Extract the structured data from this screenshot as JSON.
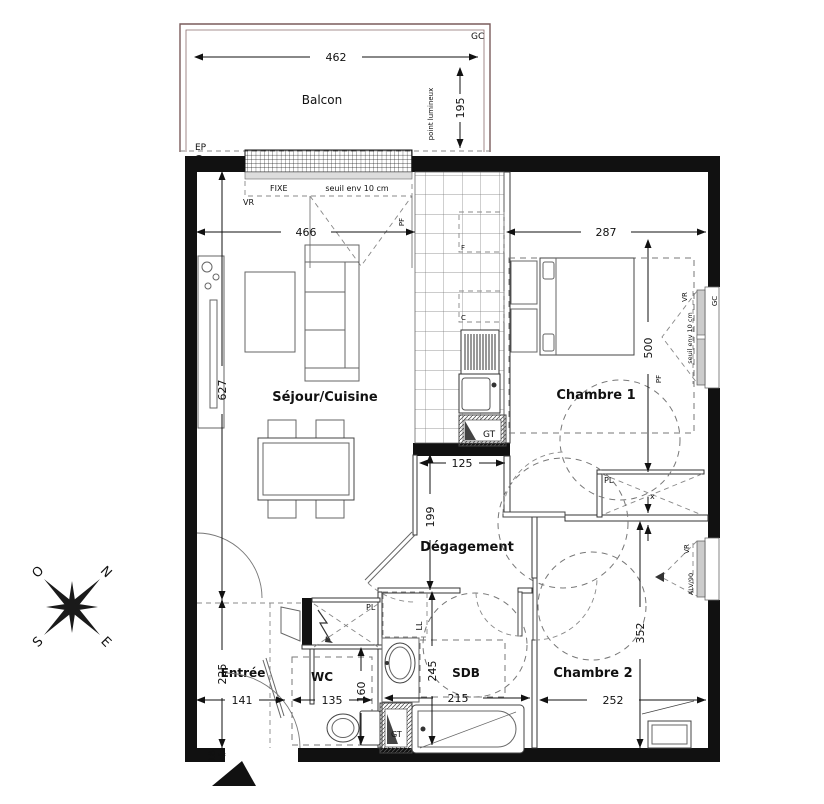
{
  "plan": {
    "rooms": {
      "balcon": "Balcon",
      "sejour_cuisine": "Séjour/Cuisine",
      "chambre1": "Chambre 1",
      "degagement": "Dégagement",
      "entree": "Entrée",
      "wc": "WC",
      "sdb": "SDB",
      "chambre2": "Chambre 2"
    },
    "dims": {
      "balcon_width": "462",
      "balcon_depth": "195",
      "sejour_width": "466",
      "chambre1_width": "287",
      "sejour_height": "627",
      "chambre1_height": "500",
      "degagement_width": "125",
      "degagement_height": "199",
      "entree_height": "225",
      "entree_width": "141",
      "wc_width": "135",
      "wc_height": "160",
      "sdb_height": "245",
      "sdb_width": "215",
      "chambre2_width": "252",
      "chambre2_height": "352",
      "wall_offset": "18"
    },
    "tags": {
      "gc": "GC",
      "ep": "EP",
      "fixe": "FIXE",
      "seuil": "seuil env 10 cm",
      "vr": "VR",
      "pf": "PF",
      "point_lumineux": "point lumineux",
      "gt": "GT",
      "pl": "PL",
      "ll": "LL",
      "fridge": "F",
      "cooktop": "C",
      "alv": "ALV/90",
      "cross": "x"
    },
    "compass": {
      "west": "O",
      "north": "N",
      "south": "S",
      "east": "E"
    }
  }
}
